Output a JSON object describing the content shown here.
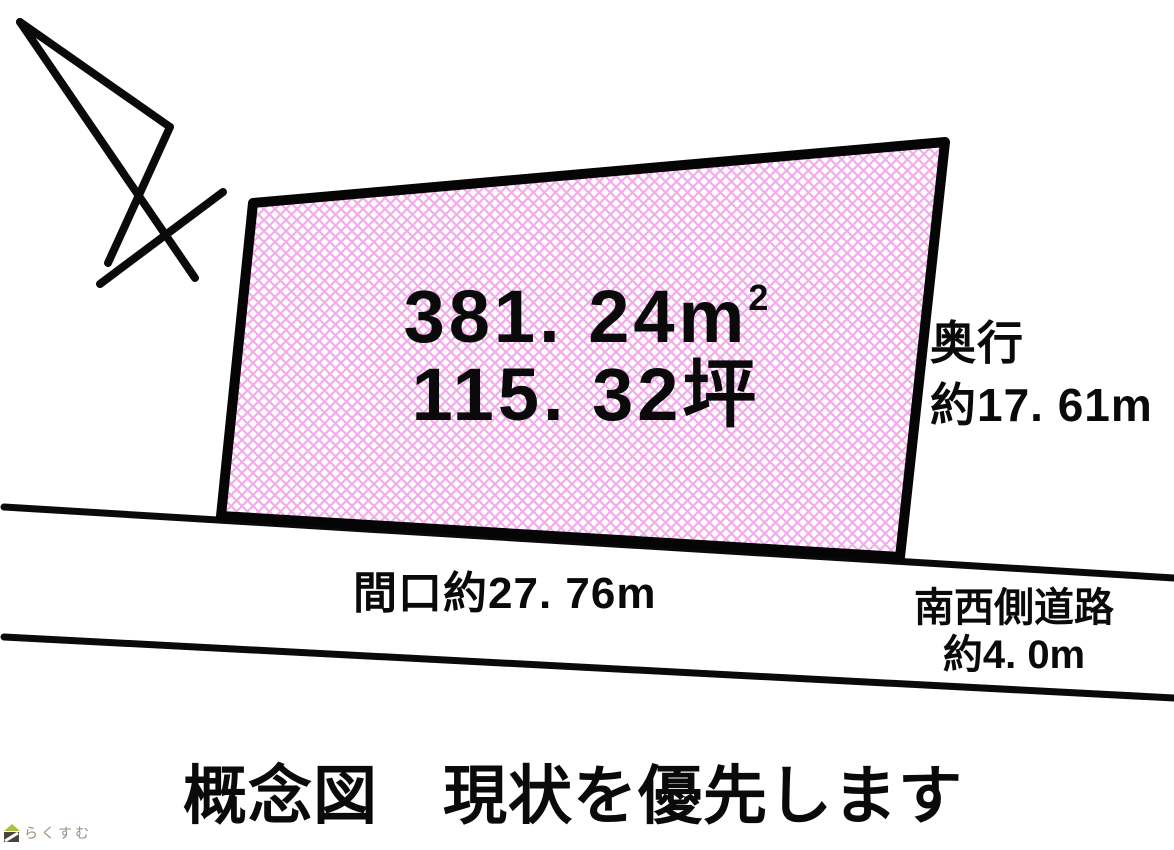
{
  "diagram": {
    "plot": {
      "area_value": "381. 24",
      "area_unit": "m",
      "area_unit_sup": "2",
      "tsubo_value": "115. 32",
      "tsubo_unit": "坪"
    },
    "labels": {
      "depth_title": "奥行",
      "depth_value": "約17. 61m",
      "frontage": "間口約27. 76m",
      "road_name": "南西側道路",
      "road_width": "約4. 0m"
    },
    "caption": "概念図　現状を優先します"
  },
  "colors": {
    "ink": "#0a0a0a",
    "hatch_pink": "#f2ace9",
    "plot_background": "#fffdff",
    "watermark_text": "#9c8b7c",
    "watermark_roof_green": "#a9c23c",
    "watermark_body_brown": "#4d4238"
  },
  "watermark": {
    "logo": "house-icon",
    "text": "らくすむ"
  }
}
